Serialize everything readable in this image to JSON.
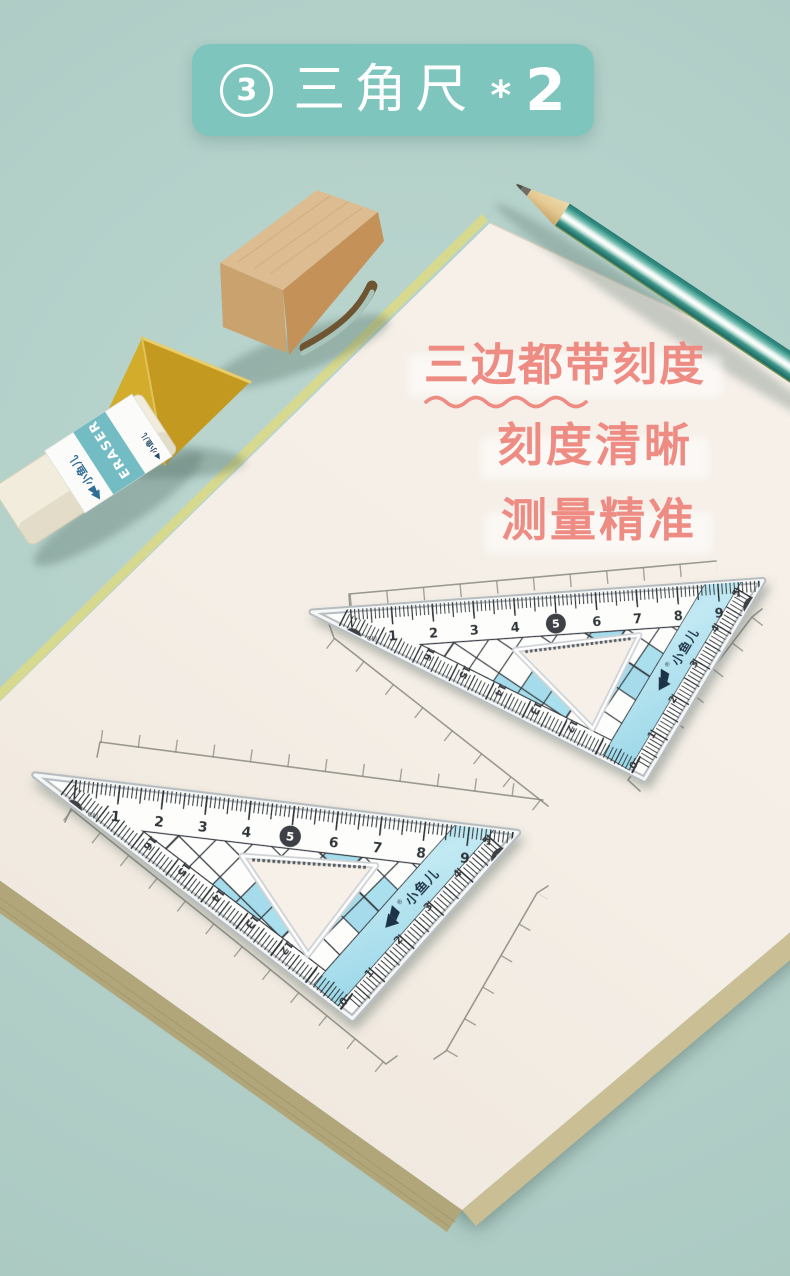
{
  "banner": {
    "number": "3",
    "title": "三角尺",
    "star": "*",
    "count": "2"
  },
  "captions": {
    "line1": "三边都带刻度",
    "line2": "刻度清晰",
    "line3": "测量精准"
  },
  "ruler": {
    "unit": "CM",
    "top_scale": [
      "0",
      "1",
      "2",
      "3",
      "4",
      "5",
      "6",
      "7",
      "8",
      "9",
      "10"
    ],
    "left_scale": [
      "16",
      "15",
      "14",
      "13",
      "12"
    ],
    "right_scale": [
      "5",
      "4",
      "3",
      "2",
      "1",
      "0"
    ],
    "reg": "®",
    "brand": "小鱼儿"
  },
  "eraser": {
    "brand": "小鱼儿",
    "label": "ERASER",
    "side_label": "小鱼儿"
  },
  "scene": {
    "props": [
      "notebook",
      "triangle-ruler-upper",
      "triangle-ruler-lower",
      "pencil",
      "eraser",
      "wooden-arch-block",
      "yellow-triangle-block"
    ],
    "colors": {
      "background": "#b3d0c9",
      "banner": "#7dc5bd",
      "caption_red": "#ee8c84",
      "paper": "#f5efe8",
      "page_stack": "#b1a679",
      "ruler_blue": "#a5dbea",
      "pencil_teal": "#2f8c82",
      "wood_light": "#dcbc90",
      "yellow_block": "#cda228",
      "eraser_teal": "#74bcc4"
    }
  }
}
